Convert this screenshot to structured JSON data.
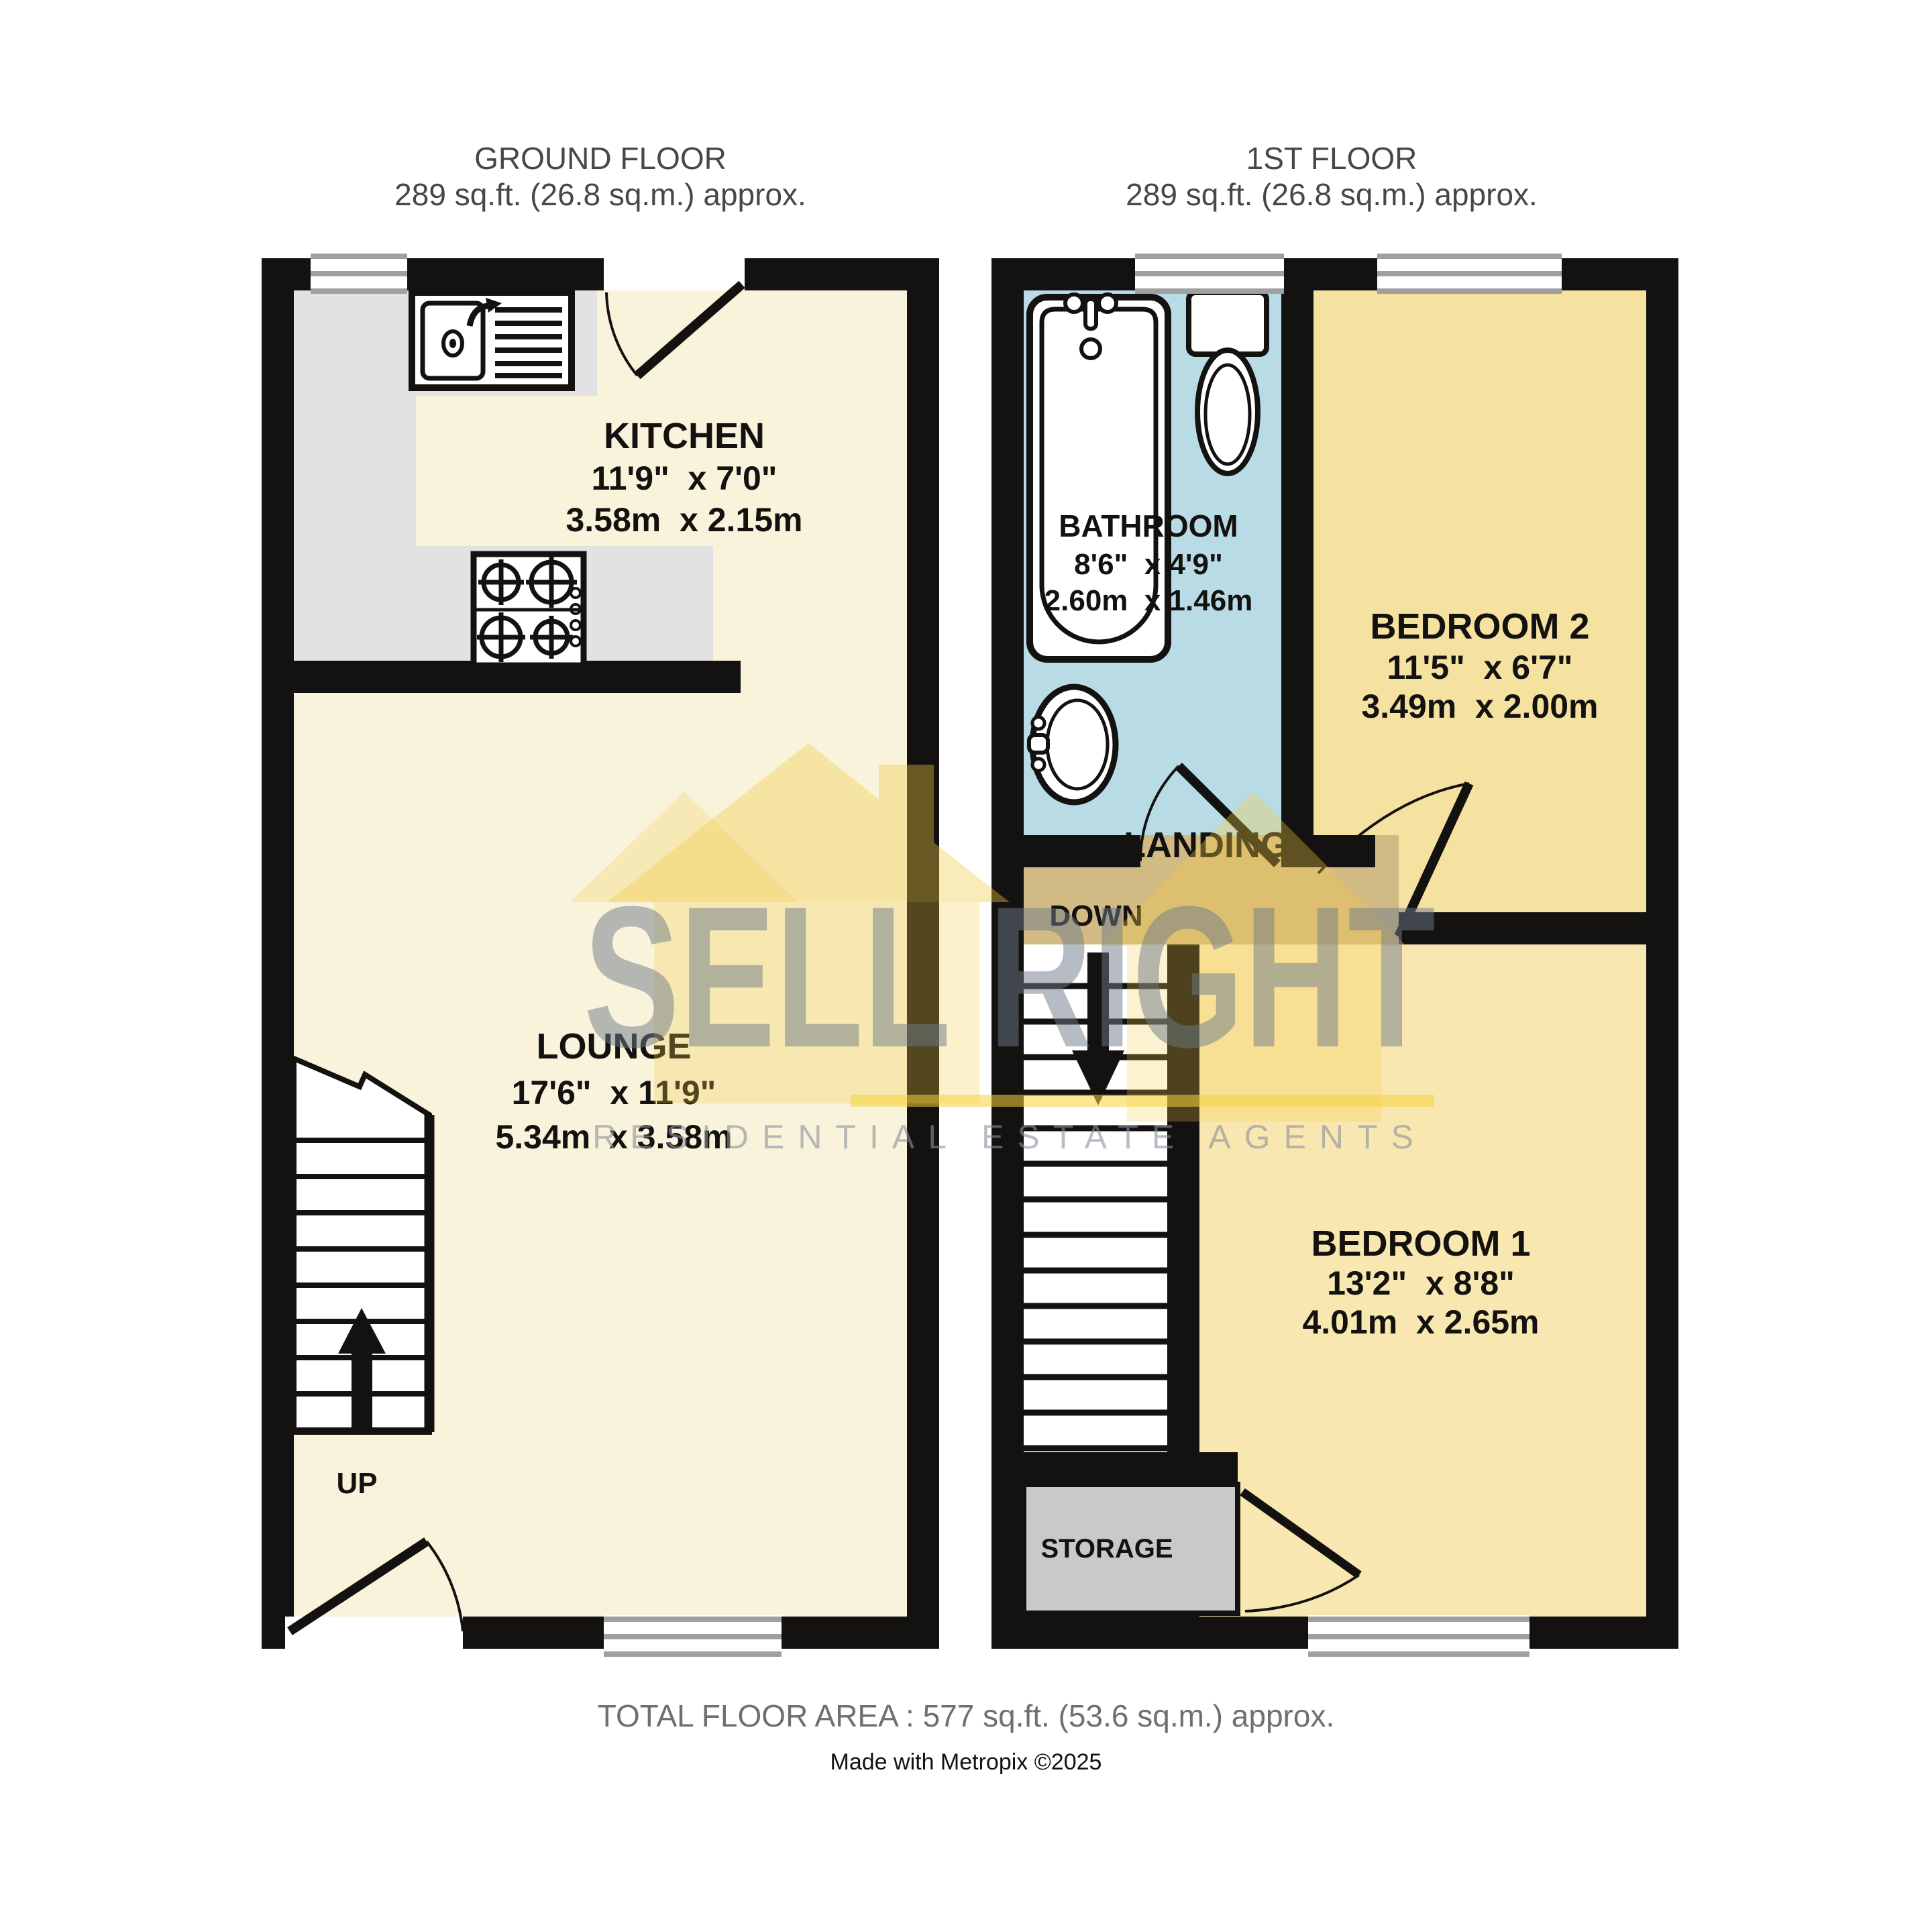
{
  "titles": {
    "ground_floor": {
      "name": "GROUND FLOOR",
      "area": "289 sq.ft. (26.8 sq.m.) approx."
    },
    "first_floor": {
      "name": "1ST FLOOR",
      "area": "289 sq.ft. (26.8 sq.m.) approx."
    }
  },
  "rooms": {
    "kitchen": {
      "name": "KITCHEN",
      "dims_imperial": "11'9\"  x 7'0\"",
      "dims_metric": "3.58m  x 2.15m"
    },
    "lounge": {
      "name": "LOUNGE",
      "dims_imperial": "17'6\"  x 11'9\"",
      "dims_metric": "5.34m  x 3.58m"
    },
    "bathroom": {
      "name": "BATHROOM",
      "dims_imperial": "8'6\"  x 4'9\"",
      "dims_metric": "2.60m  x 1.46m"
    },
    "bedroom2": {
      "name": "BEDROOM 2",
      "dims_imperial": "11'5\"  x 6'7\"",
      "dims_metric": "3.49m  x 2.00m"
    },
    "bedroom1": {
      "name": "BEDROOM 1",
      "dims_imperial": "13'2\"  x 8'8\"",
      "dims_metric": "4.01m  x 2.65m"
    },
    "landing": {
      "name": "LANDING"
    },
    "storage": {
      "name": "STORAGE"
    }
  },
  "stairs": {
    "up_label": "UP",
    "down_label": "DOWN"
  },
  "watermark": {
    "brand": "SELL RIGHT",
    "tagline": "RESIDENTIAL ESTATE AGENTS"
  },
  "footer": {
    "total_area": "TOTAL FLOOR AREA : 577 sq.ft. (53.6 sq.m.) approx.",
    "credit": "Made with Metropix ©2025"
  },
  "colors": {
    "wall": "#141210",
    "kitchen_floor": "#f8f3da",
    "lounge_floor": "#f8f3da",
    "bathroom_floor": "#b8dbe5",
    "bedroom2_floor": "#f5e1a0",
    "bedroom1_floor": "#f8e7b0",
    "landing_floor": "#d2ba85",
    "storage_floor": "#c9c9c9",
    "counter": "#e2e2e2",
    "window_line": "#a0a0a0",
    "watermark_yellow": "rgba(242,205,70,0.32)",
    "watermark_underline": "rgba(244,212,60,0.55)"
  }
}
